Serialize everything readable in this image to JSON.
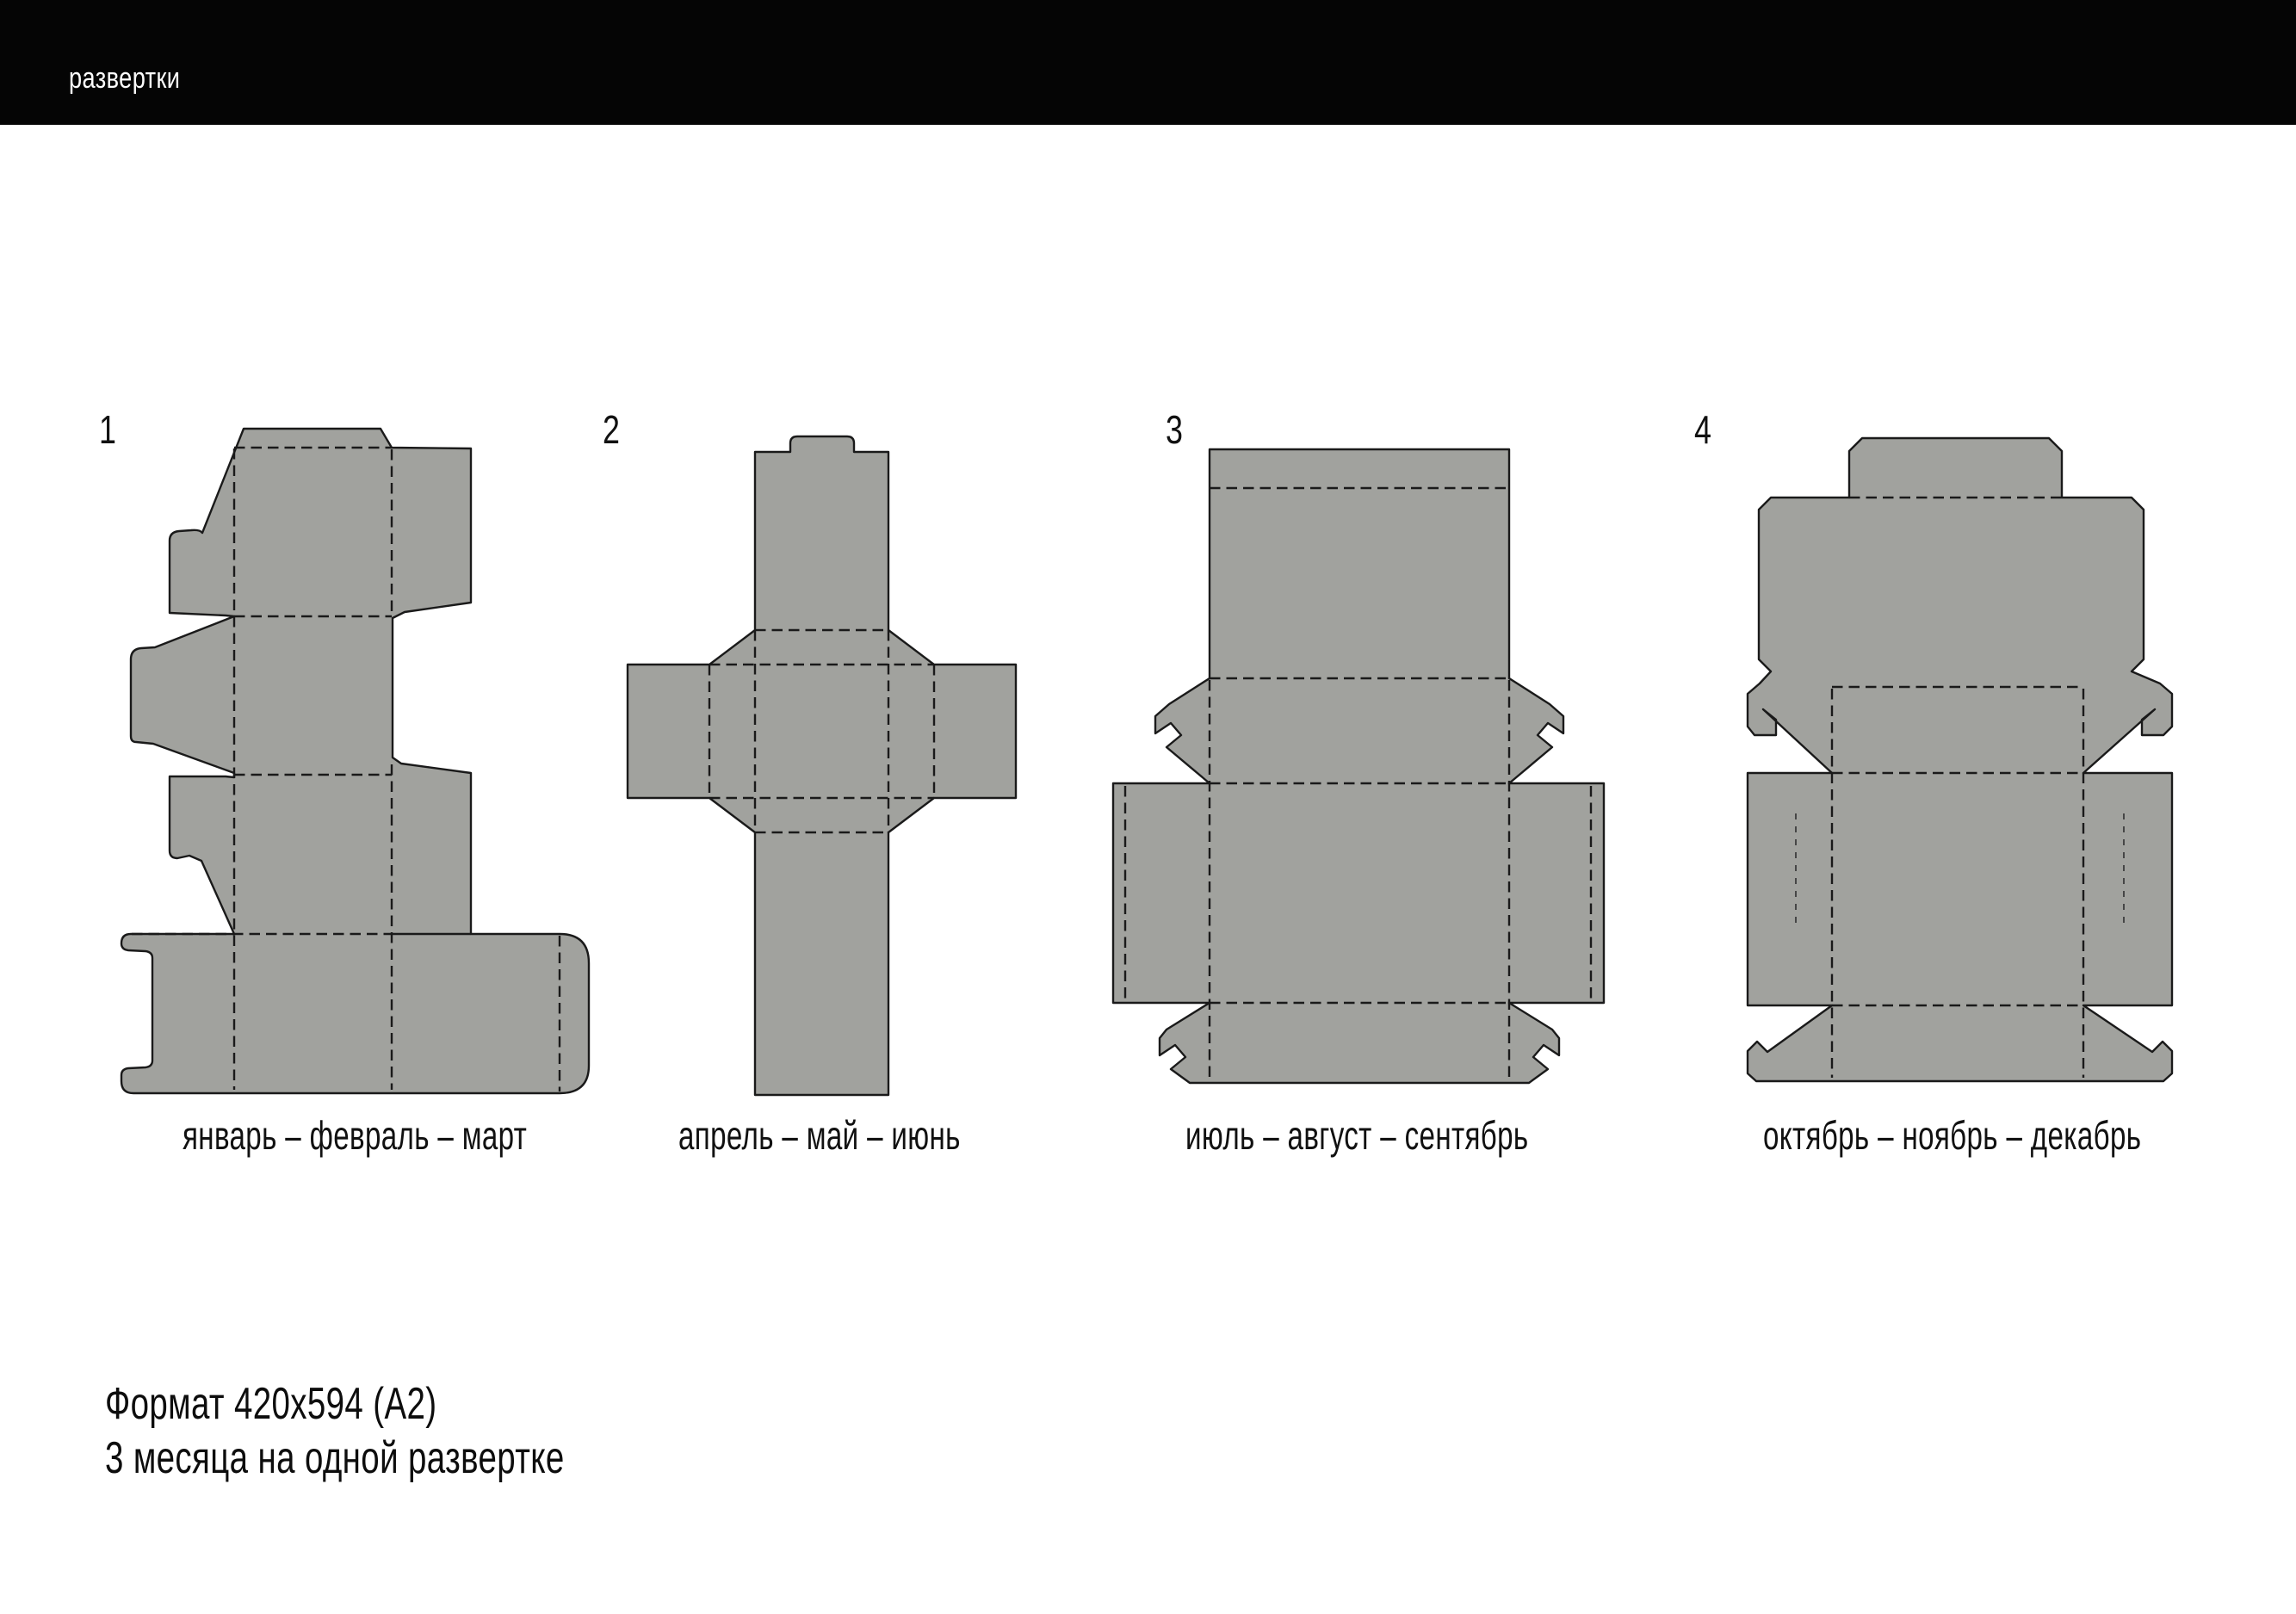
{
  "header": {
    "title": "развертки"
  },
  "colors": {
    "page_background": "#ffffff",
    "header_background": "#050505",
    "header_text": "#fdfdfd",
    "dieline_fill": "#a1a29e",
    "dieline_stroke": "#1a1a1a",
    "label_text": "#111111"
  },
  "dielines": [
    {
      "number": "1",
      "label": "январь – февраль – март"
    },
    {
      "number": "2",
      "label": "апрель – май – июнь"
    },
    {
      "number": "3",
      "label": "июль – август – сентябрь"
    },
    {
      "number": "4",
      "label": "октябрь – ноябрь – декабрь"
    }
  ],
  "footer": {
    "line1": "Формат 420x594  (А2)",
    "line2": "3 месяца на одной развертке"
  }
}
